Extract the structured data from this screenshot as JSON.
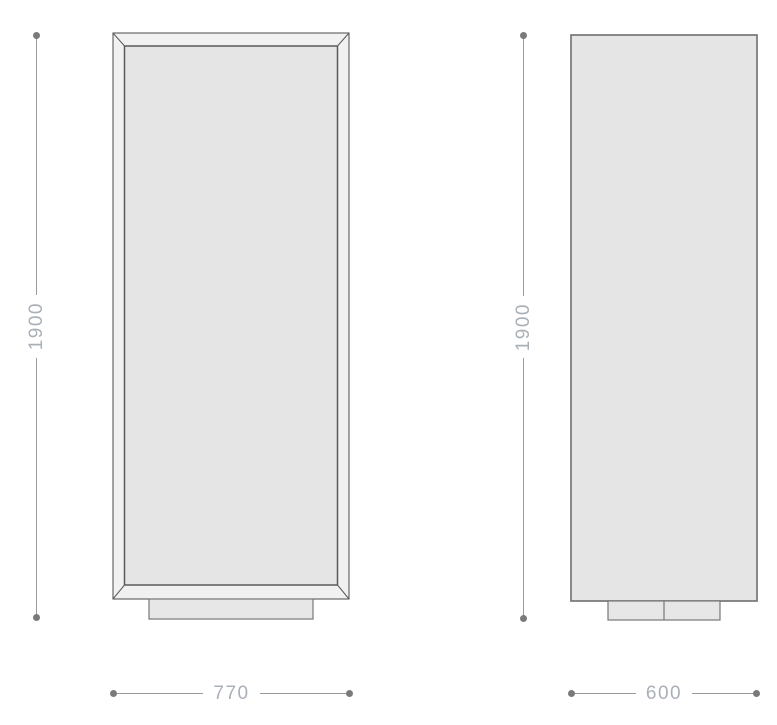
{
  "drawing": {
    "front_view": {
      "height_dimension": "1900",
      "width_dimension": "770"
    },
    "side_view": {
      "height_dimension": "1900",
      "width_dimension": "600"
    },
    "colors": {
      "background": "#ffffff",
      "panel_fill": "#e5e5e5",
      "frame_fill": "#f1f1f1",
      "plinth_fill": "#e7e7e7",
      "outline": "#5a5a5a",
      "outline_soft": "#777777",
      "dim_line": "#9a9a9a",
      "dim_dot": "#7a7a7a",
      "dim_text": "#a9b0b8"
    }
  }
}
